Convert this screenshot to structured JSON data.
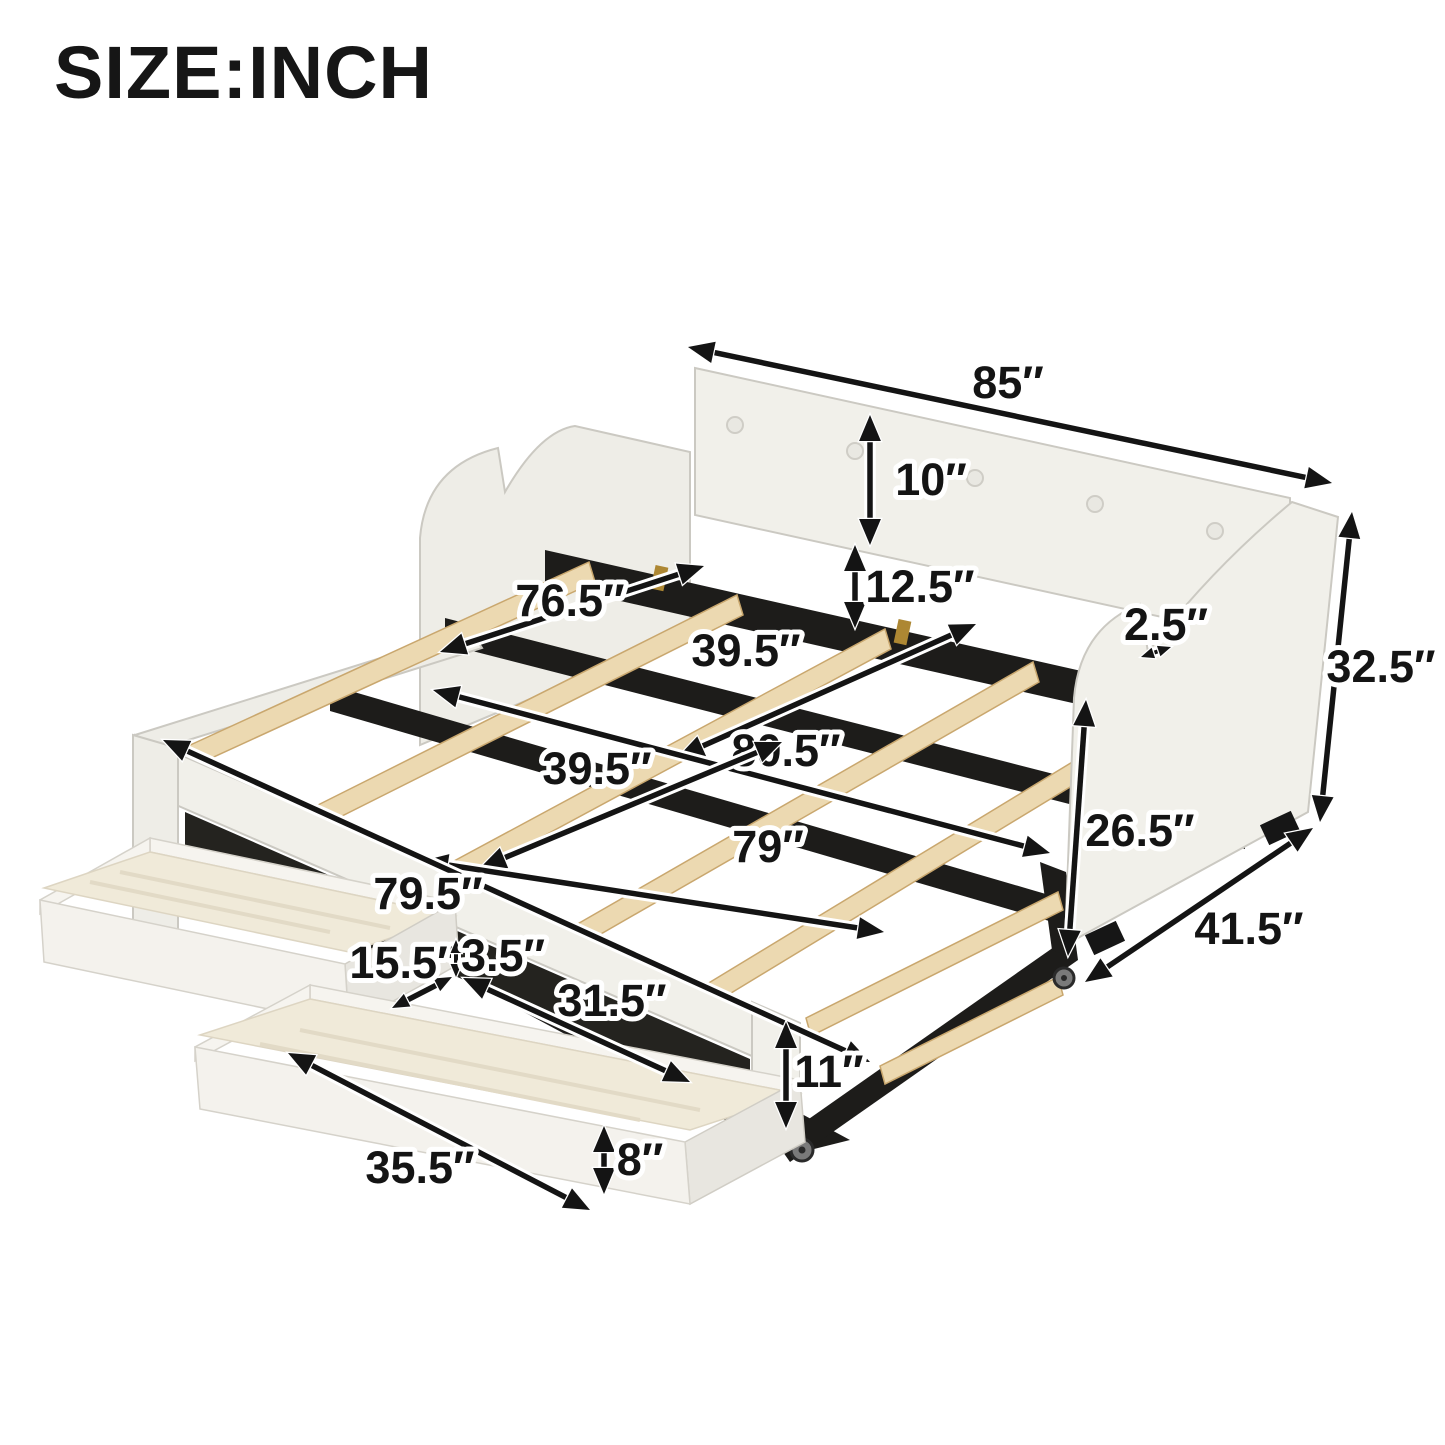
{
  "title": "SIZE:INCH",
  "unit": "inch",
  "colors": {
    "text": "#161616",
    "arrow": "#141414",
    "upholstery": "#f1f0ea",
    "wood_slat": "#ecd9b1",
    "metal_frame": "#1d1c1a",
    "drawer_wood": "#f0ead9"
  },
  "diagram": {
    "dimensions": [
      {
        "id": "length-overall",
        "label": "85″"
      },
      {
        "id": "backrest-cushion-height",
        "label": "10″"
      },
      {
        "id": "back-gap-height",
        "label": "12.5″"
      },
      {
        "id": "arm-step-depth",
        "label": "2.5″"
      },
      {
        "id": "height-overall",
        "label": "32.5″"
      },
      {
        "id": "inner-length",
        "label": "76.5″"
      },
      {
        "id": "bed-width",
        "label": "39.5″"
      },
      {
        "id": "outer-length",
        "label": "80.5″"
      },
      {
        "id": "trundle-width",
        "label": "39.5″"
      },
      {
        "id": "trundle-length",
        "label": "79″"
      },
      {
        "id": "frame-length",
        "label": "79.5″"
      },
      {
        "id": "side-panel-height",
        "label": "26.5″"
      },
      {
        "id": "depth-overall",
        "label": "41.5″"
      },
      {
        "id": "drawer-depth",
        "label": "15.5″"
      },
      {
        "id": "drawer-gap-height",
        "label": "3.5″"
      },
      {
        "id": "drawer-inner-length",
        "label": "31.5″"
      },
      {
        "id": "trundle-frame-height",
        "label": "11″"
      },
      {
        "id": "drawer-length",
        "label": "35.5″"
      },
      {
        "id": "drawer-front-height",
        "label": "8″"
      }
    ]
  }
}
